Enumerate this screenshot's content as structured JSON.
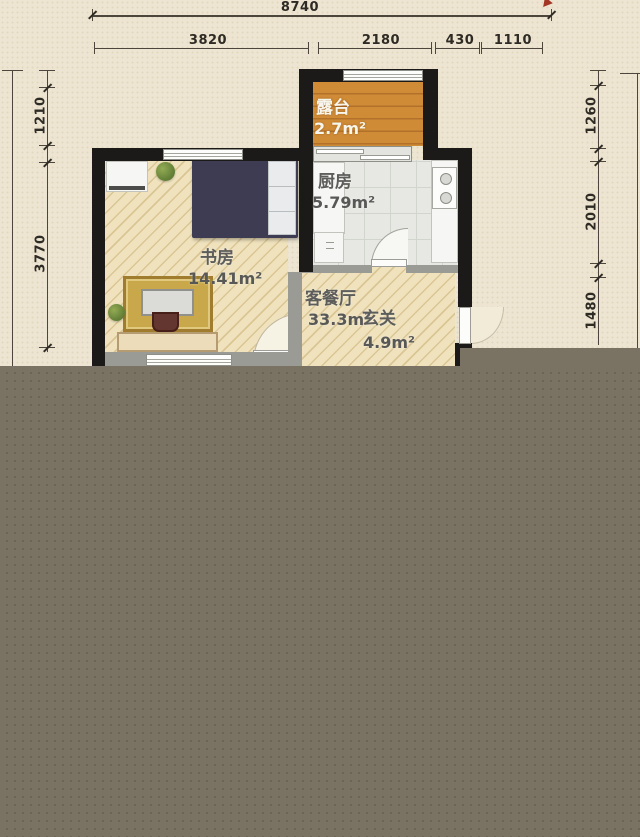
{
  "title": "apartment floor plan",
  "palette": {
    "paper": "#ede5d1",
    "censor_overlay": "#7a7262",
    "wall_black": "#1b1a18",
    "wall_gray": "#9b9b95",
    "floor_wood": "#efe2bd",
    "floor_tile": "#e7e8e4",
    "terrace_orange": "#cf8b36",
    "bed_navy": "#3d3c53",
    "rug_gold": "#c9a84c",
    "dimension_text": "#2e2a24",
    "red_mark": "#a33524"
  },
  "rooms": {
    "terrace": {
      "name": "露台",
      "area": "2.7m²"
    },
    "kitchen": {
      "name": "厨房",
      "area": "5.79m²"
    },
    "study": {
      "name": "书房",
      "area": "14.41m²"
    },
    "living_dining": {
      "name": "客餐厅",
      "area": "33.3m²"
    },
    "entry": {
      "name": "玄关",
      "area": "4.9m²"
    }
  },
  "dimensions": {
    "top_total": "8740",
    "top_segments": [
      "3820",
      "2180",
      "430",
      "1110"
    ],
    "left_segments": [
      "1210",
      "3770"
    ],
    "right_segments": [
      "1260",
      "2010",
      "1480"
    ]
  }
}
